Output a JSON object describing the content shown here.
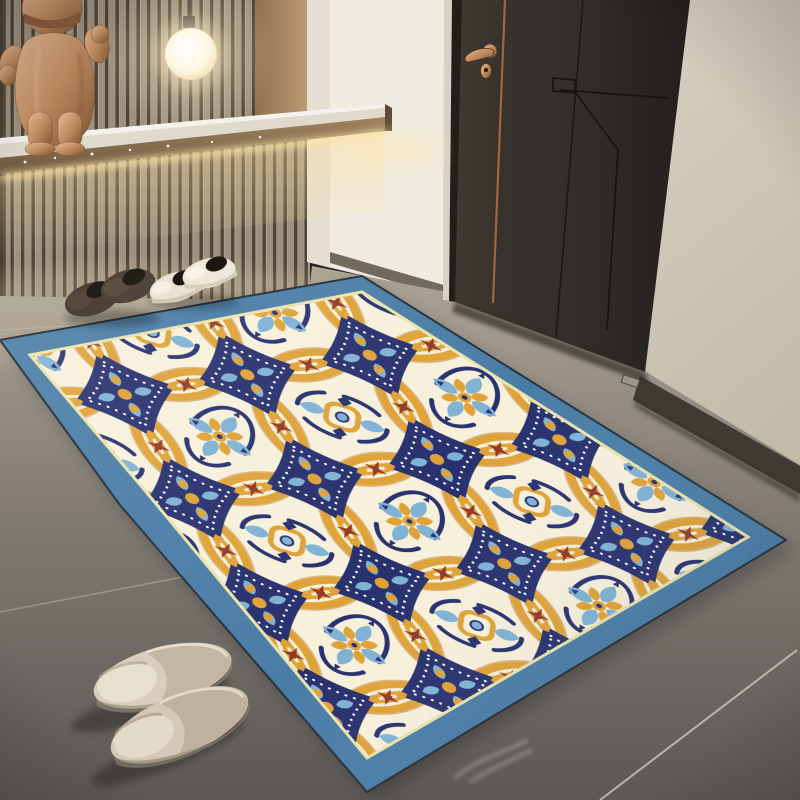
{
  "meta": {
    "type": "photograph",
    "subject": "Entryway interior with ornate medallion area rug, dark door, slat accent wall, pendant light, shoes and slippers"
  },
  "scene": {
    "objects": [
      {
        "name": "wood-slat-wall",
        "desc": "vertical wood slat accent wall, upper left"
      },
      {
        "name": "bear-sculpture",
        "desc": "metallic copper bear figurine standing on lit shelf"
      },
      {
        "name": "pendant-light",
        "desc": "glowing white globe pendant on dark cord"
      },
      {
        "name": "floating-shelf",
        "desc": "wood-edged floating shelf with under-shelf LED glow"
      },
      {
        "name": "white-wall-column",
        "desc": "white wall section between slat wall and door"
      },
      {
        "name": "interior-door",
        "desc": "dark charcoal door with brass lever handle, keyhole and copper inlay line"
      },
      {
        "name": "side-wall",
        "desc": "beige wall right of door with dark baseboard"
      },
      {
        "name": "tile-floor",
        "desc": "large gray tiles with thin grout lines"
      },
      {
        "name": "brown-shoes",
        "desc": "pair of brown suede slip-on shoes at rug top edge"
      },
      {
        "name": "white-sneakers",
        "desc": "pair of cream sneakers with black tongues"
      },
      {
        "name": "beige-slippers",
        "desc": "pair of beige closed-toe slippers at lower left"
      },
      {
        "name": "area-rug",
        "desc": "steel-blue bordered rug, cream field, interlocking orange circle lattice, navy diamond tiles, light-blue florals, maroon accents"
      }
    ]
  },
  "colors": {
    "slat_face": "#b7ab97",
    "slat_gap": "#574e41",
    "niche_wood": "#a2875f",
    "wall_white": "#f0ebe1",
    "wall_beige": "#d5cfc0",
    "baseboard": "#3f3a34",
    "door": "#37322d",
    "door_frame": "#221e1b",
    "door_edge_light": "#d9d2c4",
    "copper_inlay": "#ad6d3d",
    "brass": "#c28e4a",
    "floor": "#8a847b",
    "grout": "#d8d2c6",
    "shelf_top": "#e0dacd",
    "shelf_wood": "#8a7152",
    "led": "#ffe2a4",
    "sculpture_copper": "#c08b60",
    "cord": "#3a3835",
    "globe": "#fffcf2",
    "glow": "#ffeec4",
    "rug_border": "#4a7da6",
    "rug_trim": "#eae3ab",
    "rug_cream": "#f7f0db",
    "rug_orange": "#dfa237",
    "rug_orange_dark": "#b26d2a",
    "rug_navy": "#28316e",
    "rug_blue": "#7fb2d4",
    "rug_maroon": "#943827",
    "dot_white": "#ffffff",
    "shoe_brown": "#4d4037",
    "shoe_opening": "#241e19",
    "sneaker": "#eae3d4",
    "sneaker_black": "#1b1813",
    "slipper": "#d9cebd",
    "slipper_inner": "#e8dfcf",
    "slipper_shade": "#c3b6a2"
  }
}
